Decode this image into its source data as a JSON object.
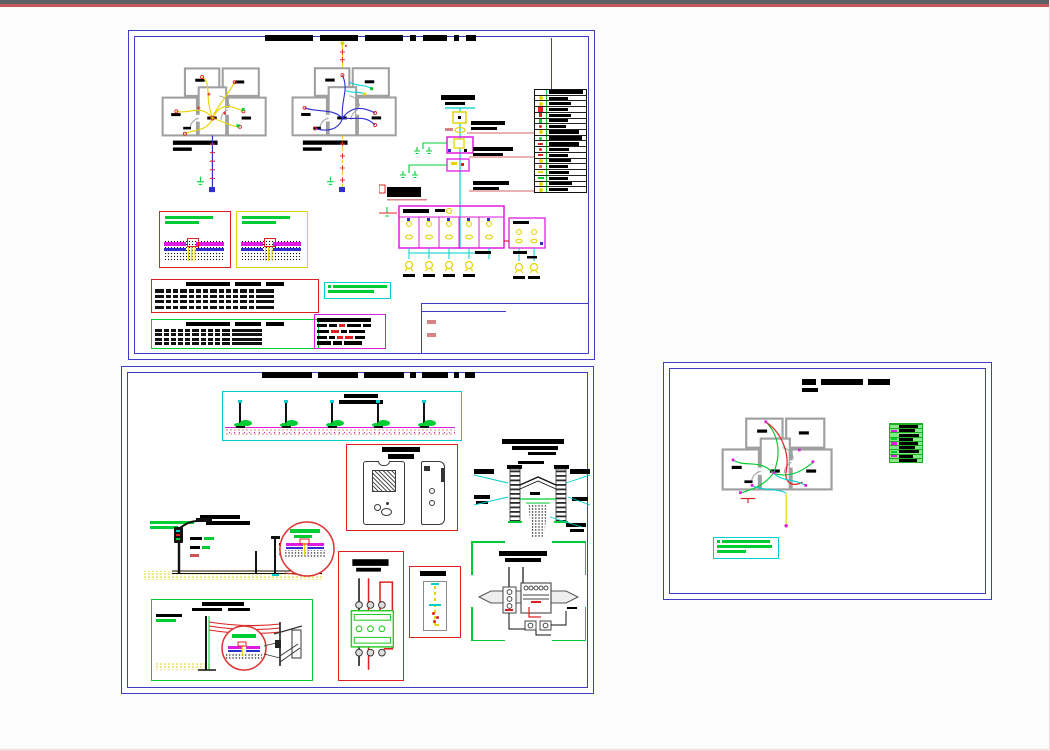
{
  "chrome": {
    "canvas_bg": "#fcfcfd",
    "top_bar_gray": "#5e6066",
    "top_bar_red": "#c4565c",
    "edge_pink": "#f6dada",
    "sheet_border": "#3d3dc8",
    "paper": "#ffffff"
  },
  "palette": {
    "ink": "#000000",
    "wall": "#a0a0a0",
    "yellow": "#e6d400",
    "red": "#e02020",
    "salmon": "#d98484",
    "green": "#00cc33",
    "cyan": "#00cfcf",
    "magenta": "#e11ae1",
    "blue": "#2f2fd0",
    "orange": "#e07820",
    "dark": "#333333"
  },
  "sheet1": {
    "title_dashes": [
      48,
      38,
      38,
      6,
      24,
      5,
      10
    ],
    "riser_title": [
      34,
      20
    ],
    "legend_rows": [
      {
        "sym": "none",
        "shape": "none",
        "w": 0.92,
        "h": 4
      },
      {
        "sym": "yellow",
        "shape": "dot",
        "w": 0.5,
        "h": 3
      },
      {
        "sym": "yellow",
        "shape": "dot",
        "w": 0.6,
        "h": 3
      },
      {
        "sym": "red",
        "shape": "sq",
        "w": 0.5,
        "h": 3
      },
      {
        "sym": "red",
        "shape": "sq_sm",
        "w": 0.6,
        "h": 3
      },
      {
        "sym": "green",
        "shape": "sq_sm",
        "w": 0.52,
        "h": 3
      },
      {
        "sym": "red",
        "shape": "dot_sm",
        "w": 0.45,
        "h": 3
      },
      {
        "sym": "yellow",
        "shape": "dot",
        "w": 0.8,
        "h": 4
      },
      {
        "sym": "green",
        "shape": "dot_sm",
        "w": 0.9,
        "h": 4
      },
      {
        "sym": "red",
        "shape": "tick",
        "w": 0.82,
        "h": 4
      },
      {
        "sym": "red",
        "shape": "dot_sm",
        "w": 0.55,
        "h": 3
      },
      {
        "sym": "red",
        "shape": "tick",
        "w": 0.5,
        "h": 3
      },
      {
        "sym": "yellow",
        "shape": "dot",
        "w": 0.6,
        "h": 3
      },
      {
        "sym": "orange",
        "shape": "sq_sm",
        "w": 0.52,
        "h": 3
      },
      {
        "sym": "yellow",
        "shape": "tick",
        "w": 0.55,
        "h": 3
      },
      {
        "sym": "green",
        "shape": "dash",
        "w": 0.5,
        "h": 3
      },
      {
        "sym": "yellow",
        "shape": "dot",
        "w": 0.62,
        "h": 3
      },
      {
        "sym": "yellow",
        "shape": "dot",
        "w": 0.5,
        "h": 3
      }
    ],
    "panel": {
      "lamps_main": 4,
      "lamps_aux": 2
    },
    "detail_a_lines": [
      0.85,
      0.6
    ],
    "detail_b_lines": [
      0.85,
      0.6
    ],
    "table_red": {
      "title": [
        44,
        26,
        18
      ],
      "rows": 4,
      "cols": [
        9,
        5,
        5,
        7,
        5,
        5,
        5,
        7,
        5,
        5,
        5,
        7,
        5,
        18
      ]
    },
    "table_green": {
      "title": [
        44,
        26,
        18
      ],
      "rows": 4,
      "cols": [
        7,
        5,
        5,
        5,
        5,
        7,
        5,
        5,
        5,
        8,
        30
      ]
    },
    "notes_lines": [
      0.94,
      0.78
    ],
    "table_magenta": [
      [
        {
          "c": "ink",
          "w": 54
        }
      ],
      [
        {
          "c": "ink",
          "w": 10
        },
        {
          "c": "ink",
          "w": 8
        },
        {
          "c": "red",
          "w": 6
        },
        {
          "c": "ink",
          "w": 14
        },
        {
          "c": "ink",
          "w": 8
        }
      ],
      [
        {
          "c": "ink",
          "w": 12
        },
        {
          "c": "red",
          "w": 8
        },
        {
          "c": "ink",
          "w": 6
        },
        {
          "c": "ink",
          "w": 16
        }
      ],
      [
        {
          "c": "ink",
          "w": 10
        },
        {
          "c": "ink",
          "w": 6
        },
        {
          "c": "red",
          "w": 6
        },
        {
          "c": "red",
          "w": 8
        },
        {
          "c": "ink",
          "w": 10
        }
      ],
      [
        {
          "c": "ink",
          "w": 14
        },
        {
          "c": "ink",
          "w": 9
        },
        {
          "c": "ink",
          "w": 18
        }
      ]
    ]
  },
  "sheet2": {
    "title_dashes": [
      50,
      40,
      40,
      6,
      26,
      5,
      10
    ],
    "strip_labels": [
      34,
      44
    ],
    "strip_poles": 5,
    "cabinet_title": [
      38,
      26
    ],
    "manhole_title": [
      62,
      46,
      28
    ],
    "pole_detail_green_lines": [
      0.9,
      0.6
    ],
    "wall_detail_title": [
      42,
      30
    ],
    "contactor_title": [
      38,
      26
    ],
    "rod_title": [
      26
    ],
    "control_title": [
      48,
      36
    ]
  },
  "sheet3": {
    "title_dashes": [
      14,
      42,
      22
    ],
    "title_sub": [
      16
    ],
    "legend_rows": [
      {
        "sym": "none",
        "w": 0.6,
        "h": 4
      },
      {
        "sym": "magenta",
        "w": 0.5,
        "h": 3
      },
      {
        "sym": "none",
        "w": 0.62,
        "h": 3
      },
      {
        "sym": "green",
        "w": 0.45,
        "h": 3
      },
      {
        "sym": "magenta",
        "w": 0.6,
        "h": 3
      },
      {
        "sym": "none",
        "w": 0.5,
        "h": 3
      },
      {
        "sym": "green",
        "w": 0.64,
        "h": 3
      },
      {
        "sym": "magenta",
        "w": 0.45,
        "h": 3
      },
      {
        "sym": "none",
        "w": 0.56,
        "h": 3
      }
    ],
    "notes_lines": [
      0.82,
      0.95,
      0.5
    ]
  }
}
